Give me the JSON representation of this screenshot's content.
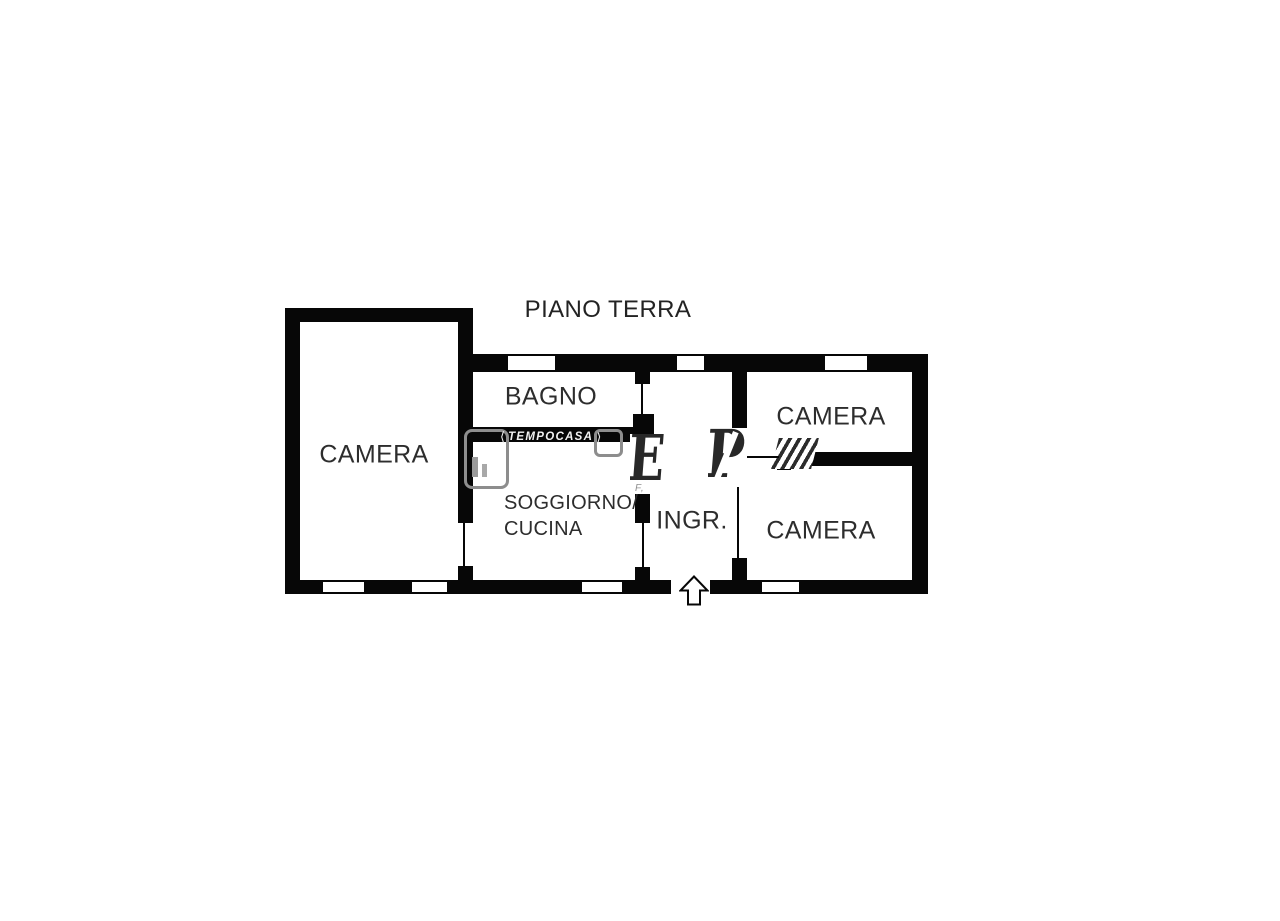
{
  "title": "PIANO TERRA",
  "rooms": {
    "camera_left": "CAMERA",
    "bagno": "BAGNO",
    "soggiorno_line1": "SOGGIORNO/",
    "soggiorno_line2": "CUCINA",
    "ingresso": "INGR.",
    "camera_top_right": "CAMERA",
    "camera_bottom_right": "CAMERA"
  },
  "watermark": {
    "brand": "TEMPOCASA",
    "chevron_left": "⟨",
    "chevron_right": "⟩",
    "big_letter_1": "E",
    "big_letter_2": "P",
    "fragment": "F,"
  },
  "colors": {
    "wall": "#070707",
    "label_text": "#2d2d2d",
    "watermark_dark": "#282828",
    "watermark_gray": "#8d8d8d",
    "background": "#ffffff"
  }
}
